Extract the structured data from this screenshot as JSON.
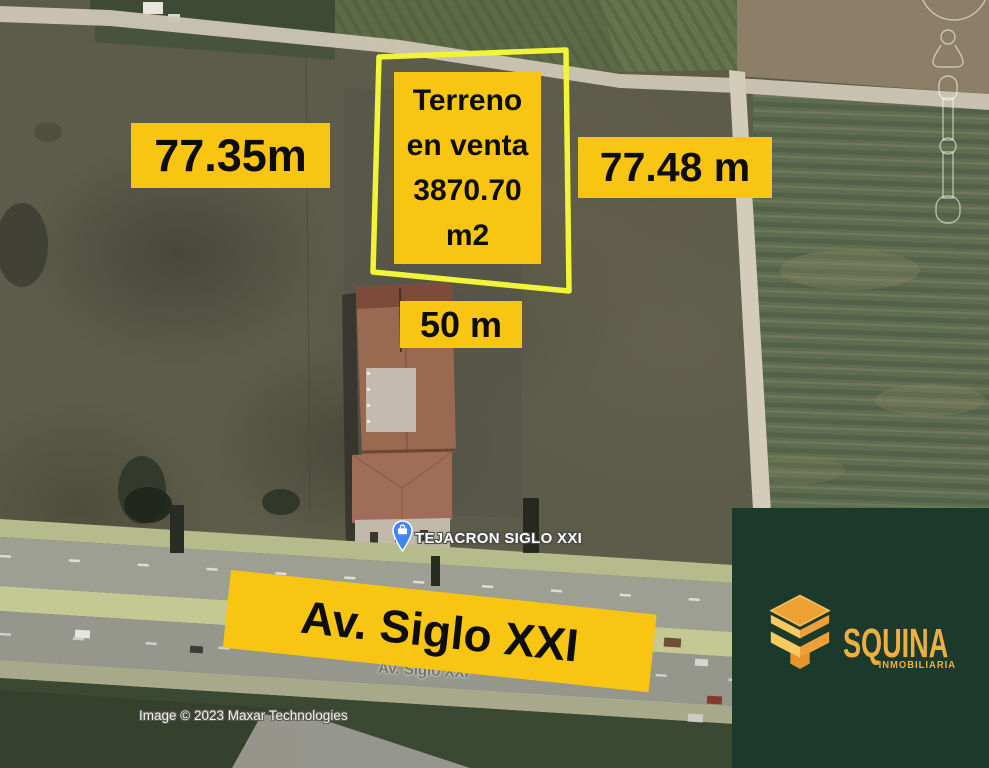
{
  "measurements": {
    "left": "77.35m",
    "right": "77.48 m",
    "front": "50 m"
  },
  "sale_box": {
    "line1": "Terreno",
    "line2": "en venta",
    "line3": "3870.70",
    "line4": "m2"
  },
  "street_banner": {
    "label": "Av. Siglo XXI"
  },
  "map": {
    "place_label": "TEJACRON SIGLO XXI",
    "faded_street_label": "Av. Siglo XXI",
    "attribution": "Image © 2023 Maxar Technologies",
    "icons": {
      "place_pin": "place-pin-icon",
      "briefcase": "briefcase-icon",
      "pegman": "pegman-icon",
      "zoom_slider": "zoom-slider",
      "look_ring": "look-ring-icon"
    }
  },
  "brand": {
    "name": "SQUINA",
    "tagline": "INMOBILIARIA"
  },
  "colors": {
    "label_bg": "#F9C513",
    "label_text": "#0D0D0D",
    "plot_outline": "#F1F437",
    "panel_bg": "#1C3A2B",
    "brand_gold": "#EFAF3F",
    "brand_gold_light": "#F8CA5F",
    "brand_orange": "#EFA233",
    "pin_blue": "#4285F4"
  }
}
